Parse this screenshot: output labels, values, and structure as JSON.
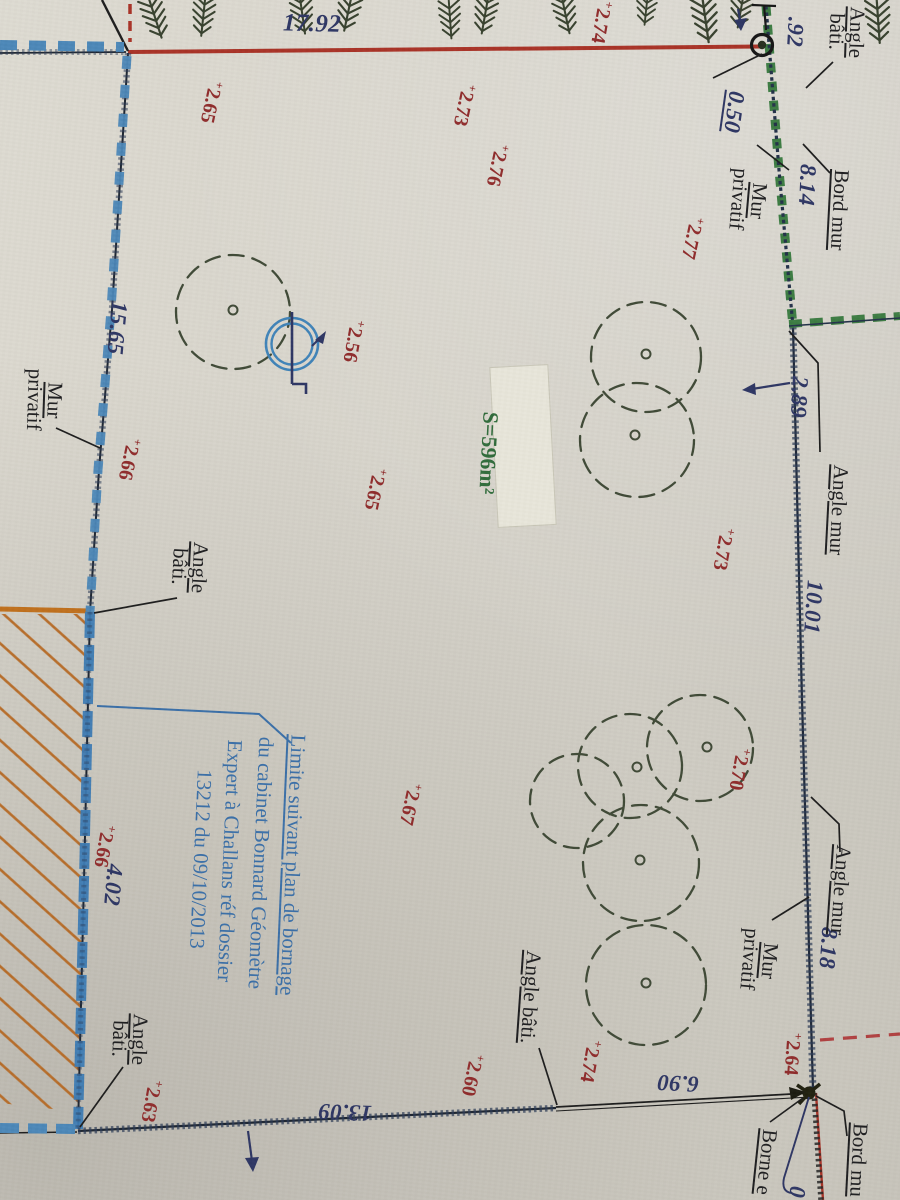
{
  "meta": {
    "title": "Plan de bornage — photo de plan topographique"
  },
  "colors": {
    "paper": "#d6d3ca",
    "ink": "#1d1d1f",
    "navy": "#2d3563",
    "red_line": "#a93226",
    "red_spot": "#8f2b2b",
    "blue_wall": "#4b87b8",
    "blue_note": "#3a6fa8",
    "green_wall": "#3c7c42",
    "green_area": "#2f6b3a",
    "orange": "#c0701c",
    "tree": "#3f4936"
  },
  "icons": {
    "spot_cross": "+"
  },
  "dims": [
    "17.92",
    ".92",
    "0.50",
    "8.14",
    "2.89",
    "10.01",
    "8.18",
    "6.90",
    "13.09",
    "15.65",
    "4.02",
    "0"
  ],
  "labels": [
    {
      "l1": "Angle",
      "l2": "bâti."
    },
    {
      "l1": "Mur",
      "l2": "privatif"
    },
    {
      "l1": "Bord mur"
    },
    {
      "l1": "Angle mur"
    },
    {
      "l1": "Angle mur"
    },
    {
      "l1": "Mur",
      "l2": "privatif"
    },
    {
      "l1": "Angle bâti."
    },
    {
      "l1": "Angle",
      "l2": "bâti."
    },
    {
      "l1": "Angle",
      "l2": "bâti."
    },
    {
      "l1": "Mur",
      "l2": "privatif"
    },
    {
      "l1": "Borne e"
    },
    {
      "l1": "Bord mu"
    }
  ],
  "spots": [
    "2.65",
    "2.73",
    "2.76",
    "2.77",
    "2.74",
    "2.56",
    "2.65",
    "2.73",
    "2.70",
    "2.67",
    "2.66",
    "2.66",
    "2.60",
    "2.74",
    "2.63",
    "2.64"
  ],
  "area_label": "S=596m²",
  "note": {
    "line1": "Limite suivant plan de bornage",
    "line2": "du cabinet Bonnard Géomètre",
    "line3": "Expert à Challans réf dossier",
    "line4": "13212 du 09/10/2013"
  }
}
